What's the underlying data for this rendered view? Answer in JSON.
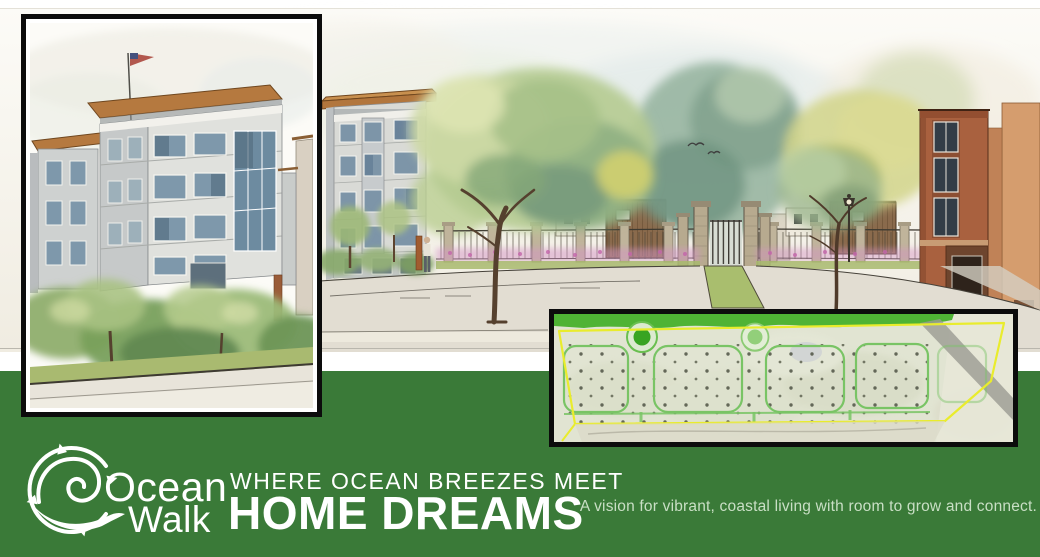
{
  "colors": {
    "band-green": "#3A7A38",
    "text-white": "#FFFFFF",
    "tagline-green": "#C9DFC5",
    "ink-black": "#0C0C0C",
    "paper-cream": "#F7F4EC",
    "boundary-yellow": "#E9EC2C",
    "plan-road-green": "#79C465",
    "greenway-green": "#47B02C",
    "roof-copper": "#B5793F",
    "brick-red": "#A9613F"
  },
  "brand": {
    "name_top": "Ocean",
    "name_bottom": "Walk",
    "icon": "wave-compass-icon"
  },
  "footer": {
    "kicker": "WHERE OCEAN BREEZES MEET",
    "headline": "HOME DREAMS",
    "tagline": "A vision for vibrant, coastal living with room to grow and connect."
  },
  "artwork": {
    "main_scene": "watercolor streetscape rendering of gated community entrance",
    "left_inset": "watercolor close-up of four-story apartment building with flag",
    "site_plan_inset": "aerial site plan with yellow property boundary, green street grid and two roundabouts"
  }
}
